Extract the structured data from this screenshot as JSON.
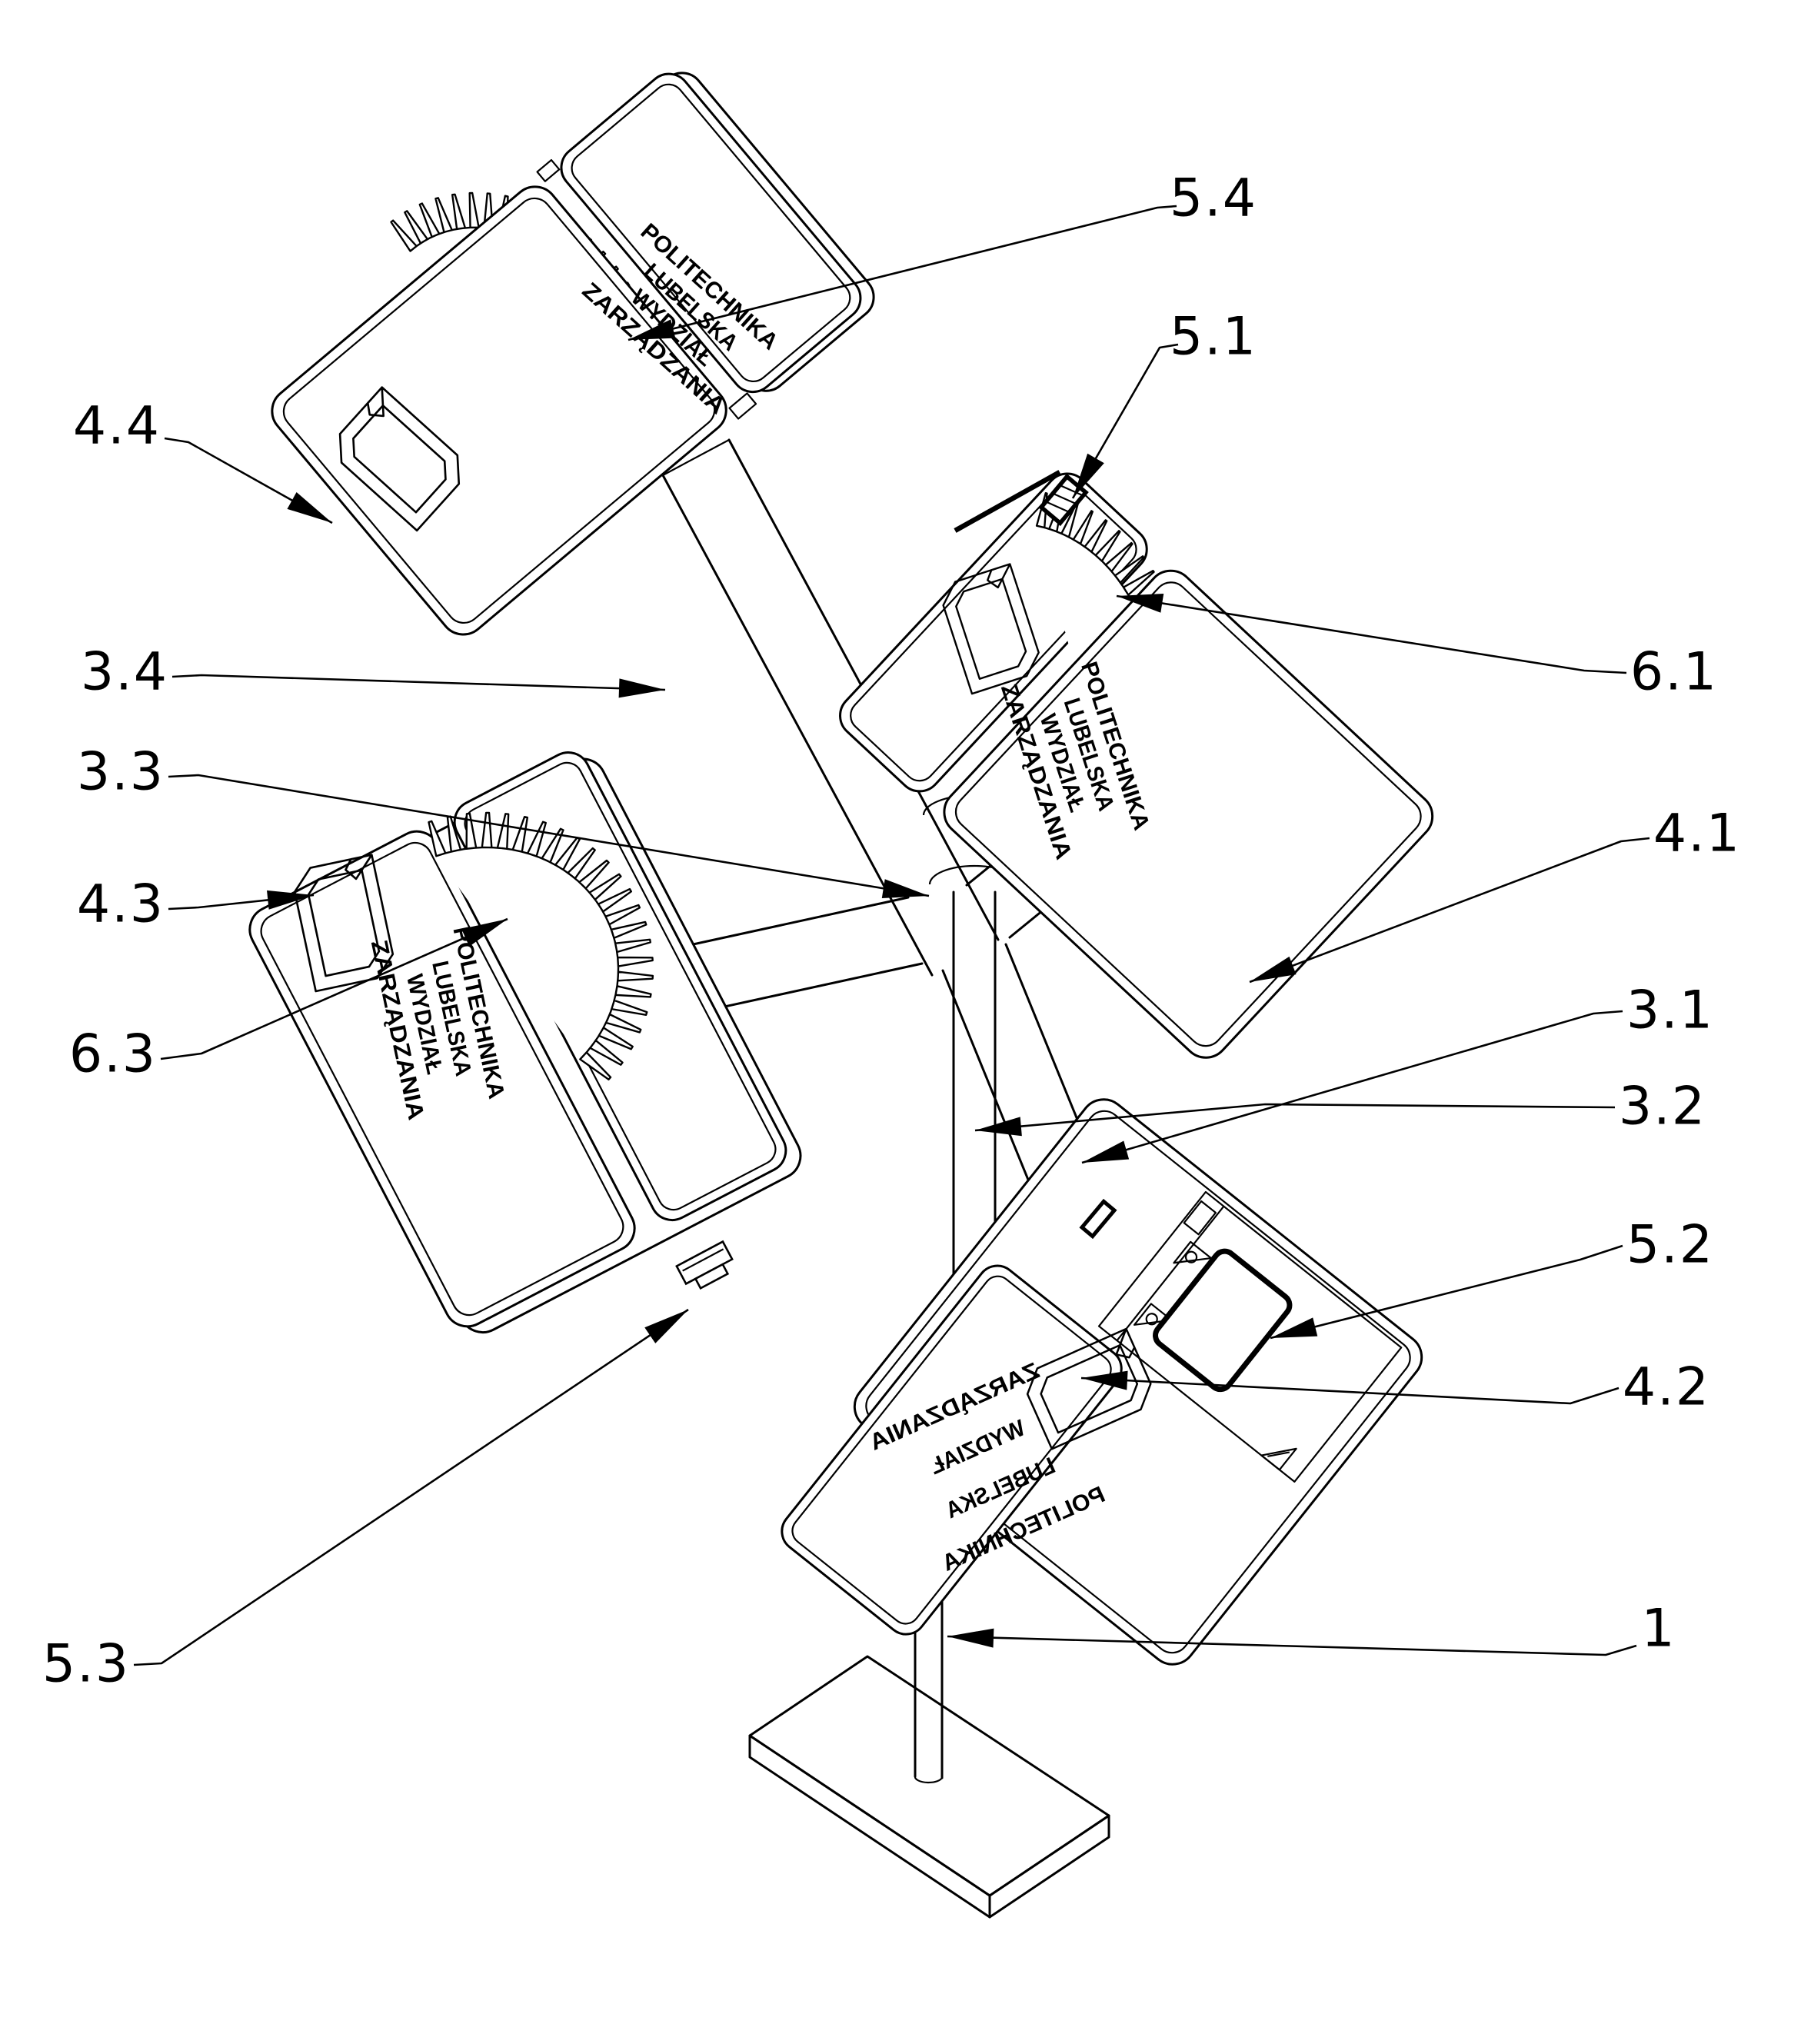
{
  "figure": {
    "kind": "patent-technical-drawing",
    "description": "Isometric line drawing of a four-panel rotating advertising stand with crown-gear hinges, support pole and base plate",
    "background": "#ffffff",
    "line_color": "#000000"
  },
  "panel_text": {
    "line1": "POLITECHNIKA",
    "line2": "LUBELSKA",
    "line3": "WYDZIAŁ",
    "line4": "ZARZĄDZANIA"
  },
  "labels": {
    "n5_4": {
      "text": "5.4"
    },
    "n5_1": {
      "text": "5.1"
    },
    "n4_4": {
      "text": "4.4"
    },
    "n3_4": {
      "text": "3.4"
    },
    "n3_3": {
      "text": "3.3"
    },
    "n4_3": {
      "text": "4.3"
    },
    "n6_3": {
      "text": "6.3"
    },
    "n5_3": {
      "text": "5.3"
    },
    "n6_1": {
      "text": "6.1"
    },
    "n4_1": {
      "text": "4.1"
    },
    "n3_1": {
      "text": "3.1"
    },
    "n3_2": {
      "text": "3.2"
    },
    "n5_2": {
      "text": "5.2"
    },
    "n4_2": {
      "text": "4.2"
    },
    "n1": {
      "text": "1"
    }
  }
}
